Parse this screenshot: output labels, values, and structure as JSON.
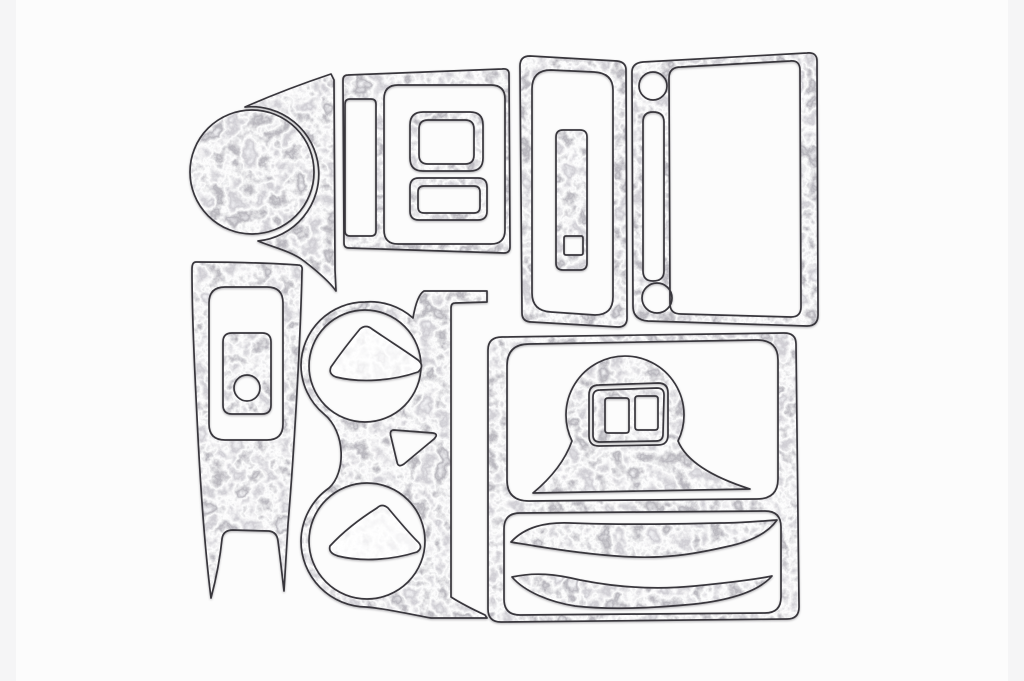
{
  "scene": {
    "type": "product-photo",
    "description": "Flat-lay scan of a car interior dash trim kit: die-cut panels and bezels in a mottled crushed-silver burl finish arranged on a white background",
    "background_color": "#fcfcfc",
    "edge_shade_color": "#efeff1",
    "material": {
      "style": "crushed silver / platinum burl veneer",
      "base_color": "#cfcdd1",
      "highlight_color": "#f4f3f5",
      "shadow_color": "#8d8b91",
      "outline_color": "#38363c",
      "hole_color": "#ffffff"
    },
    "piece_count": 17,
    "pieces": [
      {
        "id": "gauge-cluster-bezel",
        "label": "Round gauge bezel with tapered wing"
      },
      {
        "id": "radio-surround-panel",
        "label": "Center-stack panel with vent slot and switch opening"
      },
      {
        "id": "square-switch-bezel",
        "label": "Square switch bezel insert"
      },
      {
        "id": "small-switch-bezel",
        "label": "Small rectangular switch bezel insert"
      },
      {
        "id": "window-frame-trim",
        "label": "Tall rounded frame trim"
      },
      {
        "id": "pull-handle-bar",
        "label": "Rounded bar insert with square notch"
      },
      {
        "id": "glovebox-frame",
        "label": "Large frame with two round knob holes and vertical slot"
      },
      {
        "id": "console-side-trim",
        "label": "Tall console trim with forked lower end"
      },
      {
        "id": "console-inset-plate",
        "label": "Inset plate with round hole"
      },
      {
        "id": "cupholder-panel",
        "label": "Twin cup-holder panel with side rail and top arm"
      },
      {
        "id": "cupholder-insert-top",
        "label": "Rounded triangular insert, upper cup holder"
      },
      {
        "id": "cupholder-insert-bottom",
        "label": "Rounded triangular insert, lower cup holder"
      },
      {
        "id": "shifter-surround-panel",
        "label": "Large two-window surround panel"
      },
      {
        "id": "shifter-bell-trim",
        "label": "Bell-shaped shifter trim"
      },
      {
        "id": "switch-pod-insert",
        "label": "Twin-window switch pod insert"
      },
      {
        "id": "door-swoosh-upper",
        "label": "Curved accent blade, upper"
      },
      {
        "id": "door-swoosh-lower",
        "label": "Curved accent blade, lower"
      }
    ]
  }
}
